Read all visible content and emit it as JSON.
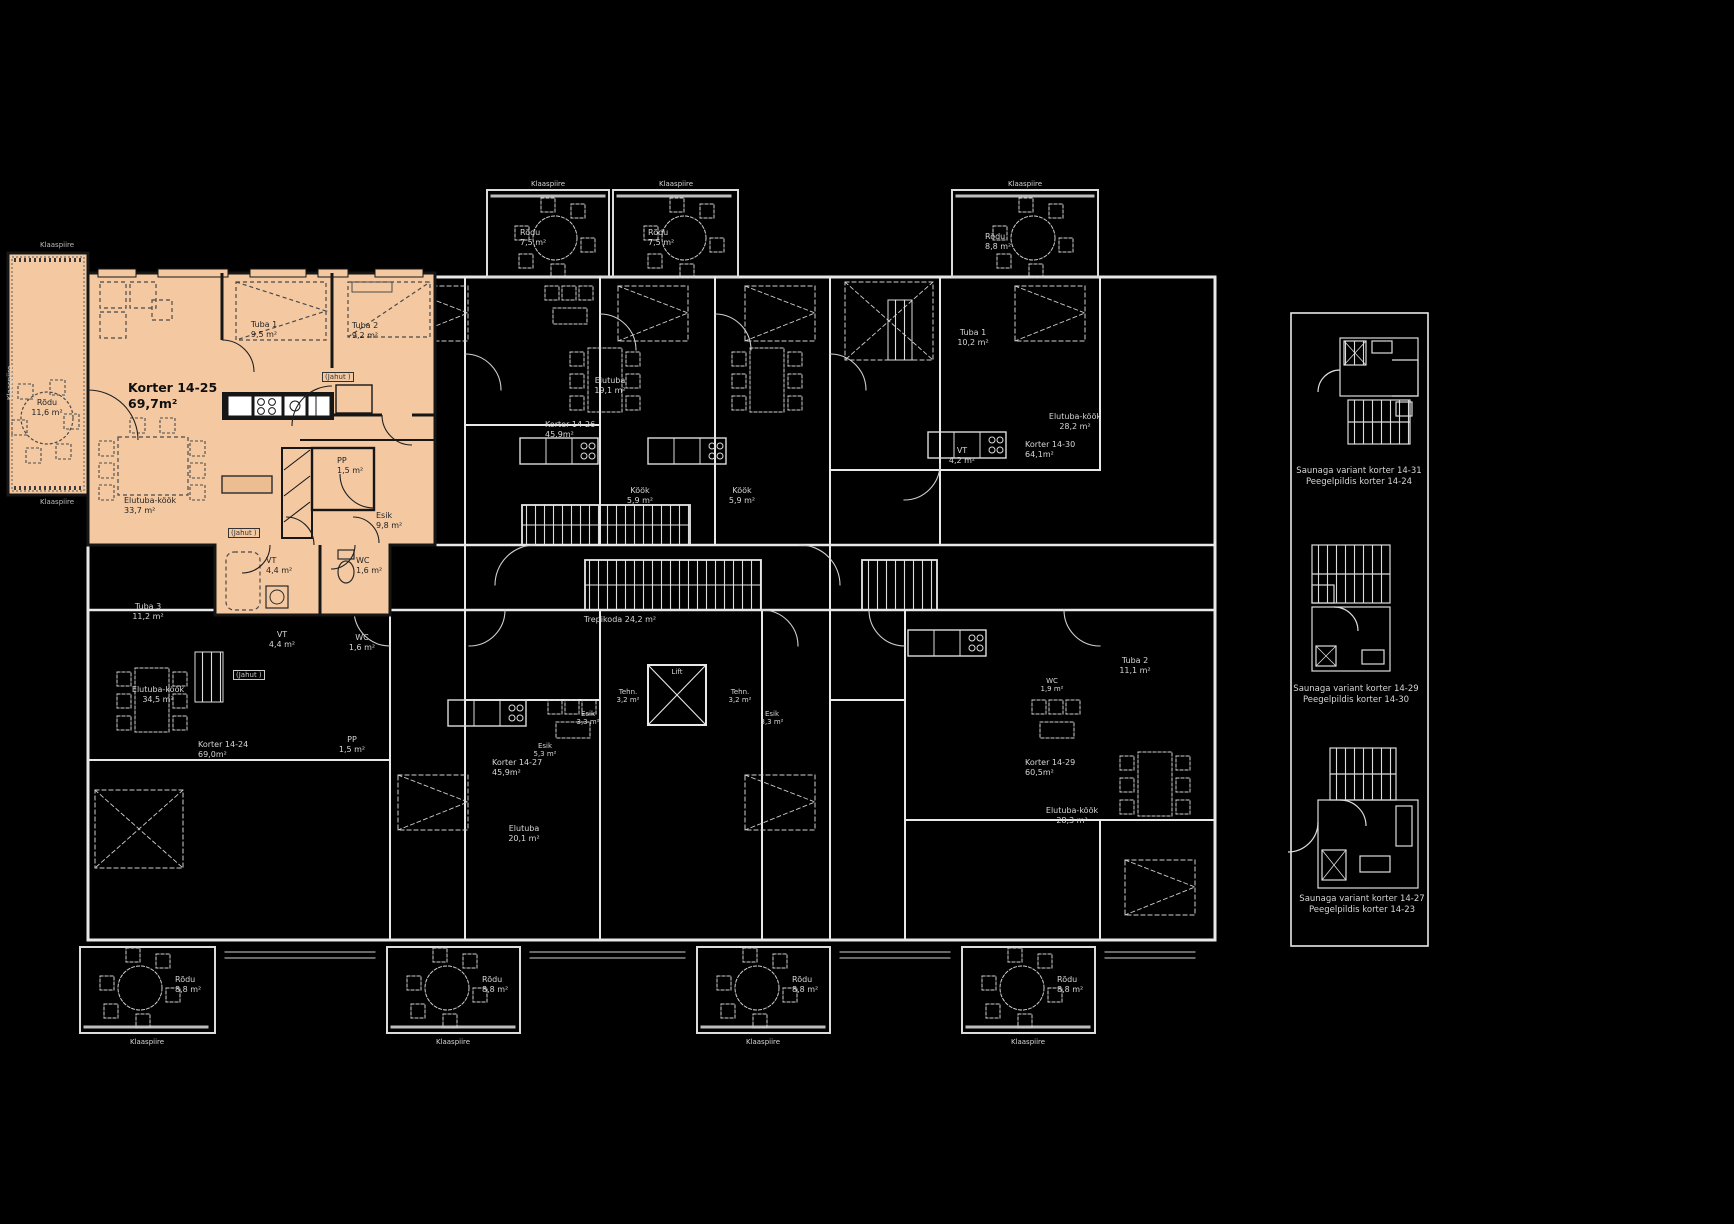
{
  "colors": {
    "highlight": "#f4c9a2",
    "background": "#000000",
    "lines": "#e8e8e8",
    "dark_ink": "#1a1a1a"
  },
  "unit": {
    "name": "Korter 14-25",
    "area": "69,7m²"
  },
  "unit_rooms": {
    "rodu": [
      "Rõdu",
      "11,6 m²"
    ],
    "tuba1": [
      "Tuba 1",
      "9,5 m²"
    ],
    "tuba2": [
      "Tuba 2",
      "9,2 m²"
    ],
    "pp": [
      "PP",
      "1,5 m²"
    ],
    "esik": [
      "Esik",
      "9,8 m²"
    ],
    "elutuba_kook": [
      "Elutuba-köök",
      "33,7 m²"
    ],
    "vt": [
      "VT",
      "4,4 m²"
    ],
    "wc": [
      "WC",
      "1,6 m²"
    ],
    "jahut": "(Jahut )"
  },
  "other_units": {
    "k1426": [
      "Korter 14-26",
      "45,9m²"
    ],
    "k1427": [
      "Korter 14-27",
      "45,9m²"
    ],
    "k1424": [
      "Korter 14-24",
      "69,0m²"
    ],
    "k1429": [
      "Korter 14-29",
      "60,5m²"
    ],
    "k1430": [
      "Korter 14-30",
      "64,1m²"
    ]
  },
  "other_rooms": {
    "elutuba191": [
      "Elutuba",
      "19,1 m²"
    ],
    "kook59": [
      "Köök",
      "5,9 m²"
    ],
    "tuba1_102": [
      "Tuba 1",
      "10,2 m²"
    ],
    "ek282": [
      "Elutuba-köök",
      "28,2 m²"
    ],
    "ek283": [
      "Elutuba-köök",
      "28,3 m²"
    ],
    "ek345": [
      "Elutuba-köök",
      "34,5 m²"
    ],
    "vt42": [
      "VT",
      "4,2 m²"
    ],
    "vt44": [
      "VT",
      "4,4 m²"
    ],
    "wc16": [
      "WC",
      "1,6 m²"
    ],
    "wc19": [
      "WC",
      "1,9 m²"
    ],
    "tuba3_112": [
      "Tuba 3",
      "11,2 m²"
    ],
    "tuba2_111": [
      "Tuba 2",
      "11,1 m²"
    ],
    "pp15": [
      "PP",
      "1,5 m²"
    ],
    "esik33": [
      "Esik",
      "3,3 m²"
    ],
    "esik53": [
      "Esik",
      "5,3 m²"
    ],
    "elutuba201": [
      "Elutuba",
      "20,1 m²"
    ],
    "trepikoda": [
      "Trepikoda",
      "24,2 m²"
    ],
    "tehn": [
      "Tehn.",
      "3,2 m²"
    ],
    "lift": "Lift"
  },
  "balcony": {
    "klaaspiire": "Klaaspiire",
    "rodu75": [
      "Rõdu",
      "7,5 m²"
    ],
    "rodu88": [
      "Rõdu",
      "8,8 m²"
    ]
  },
  "variants": [
    {
      "line1": "Saunaga variant korter 14-31",
      "line2": "Peegelpildis korter 14-24"
    },
    {
      "line1": "Saunaga variant korter 14-29",
      "line2": "Peegelpildis korter 14-30"
    },
    {
      "line1": "Saunaga variant korter 14-27",
      "line2": "Peegelpildis korter 14-23"
    }
  ]
}
